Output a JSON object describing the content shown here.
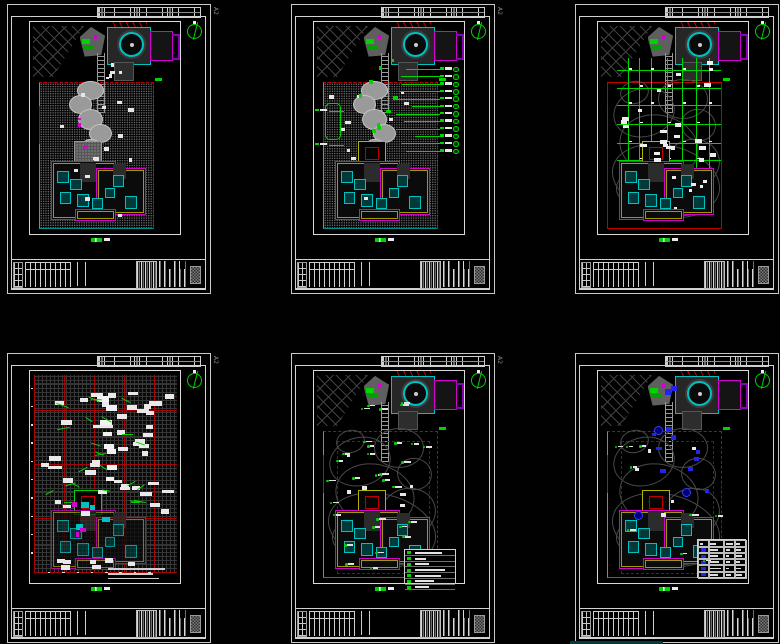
{
  "canvas": {
    "width": 780,
    "height": 644,
    "background": "#010101"
  },
  "palette": {
    "green": "#00d400",
    "red": "#c30000",
    "cyan": "#00c0c0",
    "teal": "#008b8b",
    "magenta": "#d400d4",
    "purple": "#8a00b4",
    "yellow": "#b4b400",
    "blue": "#2a2aff",
    "white": "#e8e8e8",
    "frame": "#cccccc",
    "contour": "#484848",
    "stipple": "#747474"
  },
  "layout_grid": {
    "rows": 2,
    "cols": 3
  },
  "sheets": [
    {
      "name": "paving-plan",
      "type": "paving",
      "size_label": "A2",
      "seed": 11,
      "scatter": [
        {
          "kind": "chip",
          "count": 14,
          "region": [
            8,
            32,
            76,
            92
          ],
          "color": "#e6e6e6",
          "w": [
            2,
            4
          ],
          "h": [
            1.2,
            2
          ]
        },
        {
          "kind": "chip",
          "count": 5,
          "region": [
            40,
            15,
            70,
            28
          ],
          "color": "#e6e6e6",
          "w": [
            2,
            3
          ],
          "h": [
            1.2,
            1.8
          ]
        },
        {
          "kind": "chip",
          "count": 4,
          "region": [
            20,
            35,
            60,
            60
          ],
          "color": "#d400d4",
          "w": [
            1.5,
            2.5
          ],
          "h": [
            1.2,
            1.8
          ]
        }
      ]
    },
    {
      "name": "paving-dimension-plan",
      "type": "paving_dim",
      "size_label": "A2",
      "seed": 22,
      "callouts": {
        "count": 12,
        "y_start": 21.5,
        "y_step": 3.5,
        "label_x": 84,
        "lead_from": [
          52,
          68
        ],
        "left_items": [
          [
            1,
            41
          ],
          [
            1,
            57
          ]
        ]
      },
      "scatter": [
        {
          "kind": "chip",
          "count": 10,
          "region": [
            10,
            32,
            74,
            88
          ],
          "color": "#e6e6e6",
          "w": [
            2,
            4
          ],
          "h": [
            1.2,
            2
          ]
        },
        {
          "kind": "chip",
          "count": 9,
          "region": [
            30,
            16,
            64,
            58
          ],
          "color": "#00d400",
          "w": [
            2,
            3.5
          ],
          "h": [
            1.3,
            2
          ]
        }
      ]
    },
    {
      "name": "dimension-grid-plan",
      "type": "dim",
      "size_label": "A2",
      "seed": 33,
      "contours": true,
      "grid3": {
        "xs": [
          20,
          27.5,
          35,
          46,
          56,
          65,
          73.5
        ],
        "y_range": [
          17,
          70
        ],
        "ys": [
          23,
          31,
          39,
          48,
          57,
          65
        ],
        "x_range": [
          13,
          82
        ]
      },
      "scatter": [
        {
          "kind": "chip",
          "count": 24,
          "region": [
            12,
            18,
            82,
            66
          ],
          "color": "#ededed",
          "w": [
            2.5,
            5
          ],
          "h": [
            1.3,
            2
          ]
        },
        {
          "kind": "chip",
          "count": 6,
          "region": [
            18,
            72,
            70,
            90
          ],
          "color": "#ededed",
          "w": [
            2,
            4
          ],
          "h": [
            1.2,
            1.8
          ]
        }
      ]
    },
    {
      "name": "setting-out-plan",
      "type": "setout",
      "size_label": "A2",
      "seed": 44,
      "ticks": {
        "left_count": 10,
        "bottom_count": 8
      },
      "scatter": [
        {
          "kind": "chip",
          "count": 44,
          "region": [
            4,
            6,
            90,
            66
          ],
          "color": "#e9e9e9",
          "w": [
            4,
            9
          ],
          "h": [
            1.5,
            2.6
          ]
        },
        {
          "kind": "chip",
          "count": 8,
          "region": [
            44,
            8,
            52,
            58
          ],
          "color": "#f2f2f2",
          "w": [
            5,
            8
          ],
          "h": [
            2,
            2.8
          ]
        },
        {
          "kind": "chip",
          "count": 7,
          "region": [
            10,
            88,
            80,
            92
          ],
          "color": "#e9e9e9",
          "w": [
            4,
            7
          ],
          "h": [
            1.5,
            2.2
          ]
        },
        {
          "kind": "dash",
          "count": 24,
          "region": [
            8,
            12,
            72,
            62
          ],
          "w": [
            5,
            9
          ]
        },
        {
          "kind": "chip",
          "count": 4,
          "region": [
            30,
            55,
            60,
            75
          ],
          "color": "#00c0c0",
          "w": [
            3,
            5
          ],
          "h": [
            2,
            3
          ]
        },
        {
          "kind": "chip",
          "count": 3,
          "region": [
            25,
            60,
            55,
            80
          ],
          "color": "#d400d4",
          "w": [
            2,
            4
          ],
          "h": [
            1.5,
            2.5
          ]
        }
      ]
    },
    {
      "name": "planting-plan",
      "type": "plant",
      "size_label": "A2",
      "seed": 55,
      "contours": true,
      "legend": {
        "rows": 7
      },
      "scatter": [
        {
          "kind": "plant",
          "count": 26,
          "region": [
            6,
            30,
            84,
            93
          ]
        },
        {
          "kind": "plant",
          "count": 5,
          "region": [
            30,
            12,
            60,
            28
          ]
        },
        {
          "kind": "chip",
          "count": 6,
          "region": [
            20,
            35,
            70,
            70
          ],
          "color": "#e6e6e6",
          "w": [
            2,
            4
          ],
          "h": [
            1.2,
            1.8
          ]
        }
      ]
    },
    {
      "name": "lighting-plan",
      "type": "elec",
      "size_label": "A2",
      "seed": 66,
      "contours": true,
      "legend_grid": {
        "rows": 6,
        "cols": 4
      },
      "blue_circles": [
        [
          37,
          26
        ],
        [
          56,
          55
        ],
        [
          24,
          66
        ]
      ],
      "scatter": [
        {
          "kind": "plant",
          "count": 9,
          "region": [
            8,
            35,
            80,
            90
          ]
        },
        {
          "kind": "chip",
          "count": 9,
          "region": [
            28,
            16,
            72,
            68
          ],
          "color": "#2525e8",
          "w": [
            2.5,
            4
          ],
          "h": [
            1.6,
            2.4
          ]
        },
        {
          "kind": "chip",
          "count": 2,
          "region": [
            36,
            6,
            50,
            14
          ],
          "color": "#2525e8",
          "w": [
            3,
            5
          ],
          "h": [
            2,
            3
          ]
        },
        {
          "kind": "chip",
          "count": 5,
          "region": [
            20,
            35,
            70,
            80
          ],
          "color": "#e6e6e6",
          "w": [
            2,
            4
          ],
          "h": [
            1.2,
            1.8
          ]
        }
      ]
    }
  ],
  "contours": [
    [
      30,
      42,
      20,
      11
    ],
    [
      56,
      36,
      16,
      9
    ],
    [
      40,
      58,
      26,
      14
    ],
    [
      62,
      66,
      18,
      11
    ],
    [
      34,
      78,
      22,
      9
    ],
    [
      66,
      48,
      11,
      7
    ],
    [
      24,
      33,
      9,
      5
    ],
    [
      46,
      84,
      30,
      8
    ],
    [
      45,
      74,
      36,
      16
    ]
  ],
  "villa_cyan_rooms": [
    [
      18,
      70,
      7,
      5
    ],
    [
      27,
      74,
      6,
      4
    ],
    [
      20,
      80,
      6,
      5
    ],
    [
      31,
      81,
      7,
      5
    ],
    [
      41,
      83,
      6,
      4
    ],
    [
      55,
      72,
      6,
      5
    ],
    [
      63,
      82,
      7,
      5
    ],
    [
      50,
      78,
      5,
      4
    ]
  ]
}
